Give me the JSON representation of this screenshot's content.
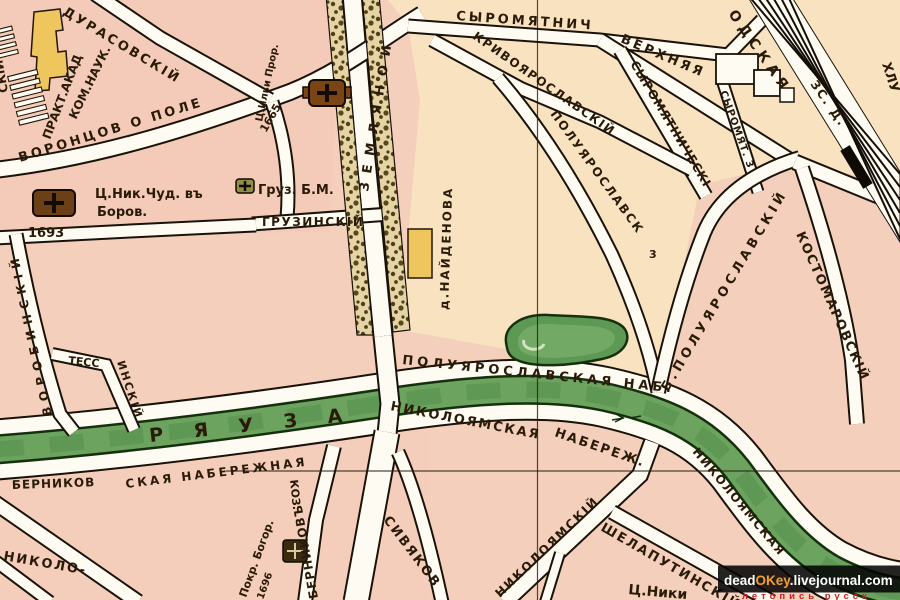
{
  "map": {
    "labels": {
      "durasovskiy": "ДУРАСОВСКІЙ",
      "vorontsovo_pole": "ВОРОНЦОВ О ПОЛЕ",
      "zemlyanoy": "ЗЕМЛЯНОЙ",
      "gruzinskiy": "ГРУЗИНСКІЙ",
      "gruz_bm": "Груз. Б.М.",
      "nik_chud_1": "Ц.Ник.Чуд. въ",
      "nik_chud_2": "Боров.",
      "year_1693": "1693",
      "ilii_pror": "Ц.Ильи Прор.",
      "year_1665": "1665",
      "vorobinskiy": "ВОРОБИНСКІЙ",
      "tessinskiy_1": "ТЕСС",
      "tessinskiy_2": "ИНСКІЙ",
      "yauza": "Р Я У З А",
      "poluyaroslavskaya_nab": "ПОЛУЯРОСЛАВСКАЯ НАБ.",
      "nikoloyamskaya_nab_1": "НИКОЛОЯМСКАЯ",
      "nikoloyamskaya_nab_2": "НАБЕРЕЖ.",
      "bernikovskaya_1": "БЕРНИКОВ",
      "bernikovskaya_2": "СКАЯ НАБЕРЕЖНАЯ",
      "bernikov_lane": "БЕРНИКОВЪ",
      "nikolo": "НИКОЛО-",
      "pokr_bogor": "Покр. Богор.",
      "year_1696": "1696",
      "koz": "КОЗ.",
      "sivyakov": "СИВЯКОВ",
      "nikoloyamskiy": "НИКОЛОЯМСКІЙ",
      "shelaputinskiy": "ШЕЛАПУТИНСКІЙ",
      "ts_nik": "Ц.Ники",
      "nikoloyamskaya_bend": "НИКОЛОЯМСКАЯ",
      "naydenova": "д.НАЙДЕНОВА",
      "m_poluyaroslavskiy": "ПОЛУЯРОСЛАВСК",
      "m_poluyaroslavskiy_num": "3",
      "b_poluyaroslavskiy": "Б.ПОЛУЯРОСЛАВСКІЙ",
      "kostomarovskiy": "КОСТОМАРОВСКІЙ",
      "krivoyaroslavskiy": "КРИВОЯРОСЛАВСКІЙ",
      "syromyatnich": "СЫРОМЯТНИЧ",
      "verkhnyaya": "ВЕРХНЯЯ",
      "syromyatnicheskiy": "СЫРОМЯТНИЧЕСКІ",
      "syromyat_3": "СЫРОМЯТ. 3",
      "zheldor_street": "ОДСКАЯ",
      "zheldor": "ЗС. Д.",
      "khl": "ХЛУ",
      "prakt_akad_1": "ПРАКТ.АКАД",
      "prakt_akad_2": "КОМ.НАУК.",
      "edge_partial": "СКІЙ"
    },
    "palette": {
      "paper": "#f3cfbc",
      "paper_light": "#f8e2c0",
      "street": "#fdfbf2",
      "ink": "#1a1208",
      "river_green": "#6ca45f",
      "pond_green": "#5d9854",
      "boulevard_tan": "#e7d4a4",
      "building_yellow": "#efc65e",
      "church_brown": "#6b4016"
    }
  },
  "watermark": {
    "prefix": "dead",
    "mid": "OKey",
    "suffix": ".livejournal",
    "tld": ".com",
    "tagline": "летопись русск",
    "orange": "#f29d35",
    "red": "#c62222"
  }
}
